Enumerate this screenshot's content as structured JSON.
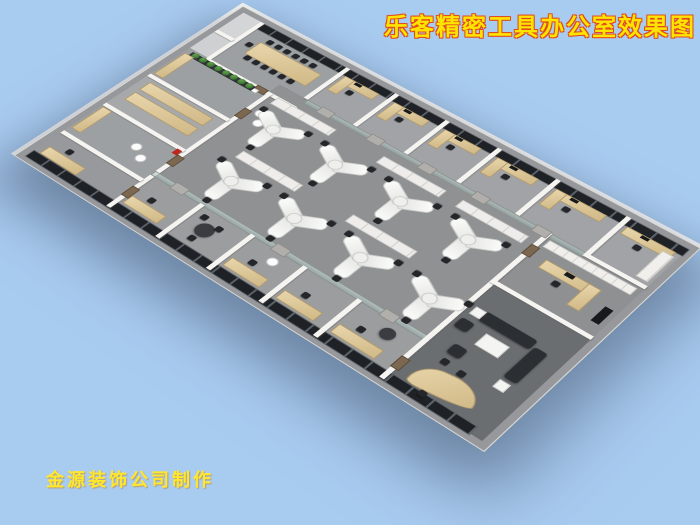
{
  "title": {
    "text": "乐客精密工具办公室效果图",
    "color": "#ffe400",
    "outline_color": "#e04b1e"
  },
  "credit": {
    "text": "金源装饰公司制作",
    "color": "#ffe72e"
  },
  "scene": {
    "type": "3d-isometric-office-floorplan-rendering",
    "background_color": "#a8cbf0",
    "colors": {
      "floor_gray": "#96989b",
      "floor_executive": "#6b6e71",
      "walls_white": "#f5f4f1",
      "window_band_black": "#1e2125",
      "wood_furniture": "#d8c195",
      "white_workstations": "#f4f4f2",
      "office_chairs": "#24262a",
      "sofa_dark": "#2b2e32",
      "plants_green": "#3e7c33",
      "glass_partition": "#9fb3ae",
      "fire_extinguisher_red": "#c0271c"
    },
    "rooms_visible": [
      "conference-room-with-long-table",
      "row-of-private-offices-along-window-wall",
      "open-office-with-y-shaped-workstations",
      "pantry-with-plant-row",
      "storage-room-with-wood-counters",
      "small-offices-lower-window-wall",
      "secretary-office",
      "executive-office-with-sofa-and-curved-desk"
    ]
  }
}
